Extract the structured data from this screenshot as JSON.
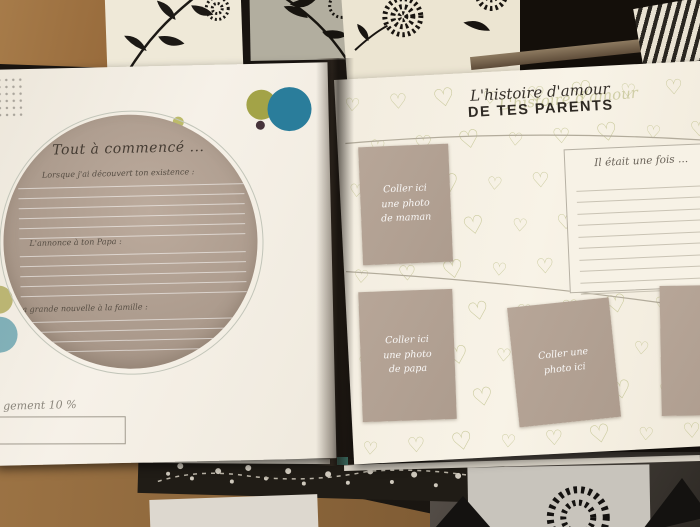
{
  "book": {
    "left_page": {
      "title": "Tout à commencé ...",
      "prompt_1": "Lorsque j'ai découvert ton existence :",
      "prompt_2": "L'annonce à ton Papa :",
      "prompt_3": "La grande nouvelle à la famille :",
      "loading_label": "gement 10 %"
    },
    "right_page": {
      "title_script": "L'histoire d'amour",
      "title_caps": "DE TES PARENTS",
      "once_upon": "Il était une fois ...",
      "photo_maman": {
        "l1": "Coller ici",
        "l2": "une photo",
        "l3": "de maman"
      },
      "photo_papa": {
        "l1": "Coller ici",
        "l2": "une photo",
        "l3": "de papa"
      },
      "photo_any": {
        "l1": "Coller une",
        "l2": "photo ici"
      }
    }
  },
  "colors": {
    "taupe_photo_block": "#b2a294",
    "heart_sage": "#c2c390",
    "teal_circle": "#2a7d9b",
    "olive_circle": "#a3a347",
    "page_cream": "#f5f0e6",
    "table_dark": "#1a1410",
    "cardboard": "#9c7344"
  }
}
